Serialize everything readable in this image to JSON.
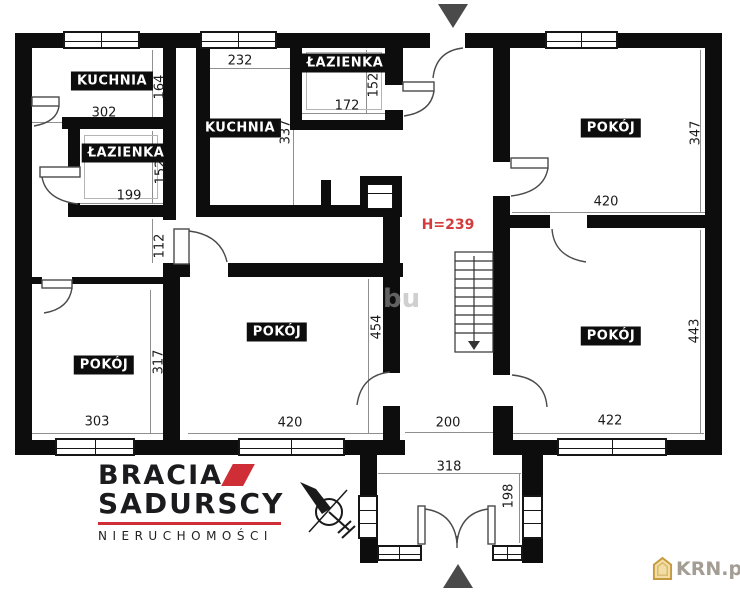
{
  "plan": {
    "type": "floor-plan",
    "rooms": [
      {
        "id": "kuchnia-top-left",
        "label": "KUCHNIA"
      },
      {
        "id": "lazienka-left",
        "label": "ŁAZIENKA"
      },
      {
        "id": "kuchnia-center",
        "label": "KUCHNIA"
      },
      {
        "id": "lazienka-top",
        "label": "ŁAZIENKA"
      },
      {
        "id": "pokoj-top-right",
        "label": "POKÓJ"
      },
      {
        "id": "pokoj-bottom-right",
        "label": "POKÓJ"
      },
      {
        "id": "pokoj-bottom-left",
        "label": "POKÓJ"
      },
      {
        "id": "pokoj-center",
        "label": "POKÓJ"
      }
    ],
    "dims": {
      "w232": "232",
      "w302": "302",
      "h164": "164",
      "h152_bath1": "152",
      "w199": "199",
      "h112": "112",
      "h317": "317",
      "w303": "303",
      "h337": "337",
      "w172": "172",
      "h152_bath2": "152",
      "h454": "454",
      "w420_center": "420",
      "w200": "200",
      "h347": "347",
      "w420_tr": "420",
      "h443": "443",
      "w422": "422",
      "w318": "318",
      "h198": "198"
    },
    "height_label": "H=239",
    "colors": {
      "wall": "#0d0d0d",
      "dim_text": "#1a1a1a",
      "height_red": "#d23c3c"
    }
  },
  "watermark": {
    "text": "bu"
  },
  "branding": {
    "name_line1": "BRACIA",
    "name_line2": "SADURSCY",
    "tagline": "NIERUCHOMOŚCI",
    "accent_color": "#cf2e36"
  },
  "portal": {
    "label": "KRN.pl",
    "icon_color": "#e8c87a"
  }
}
